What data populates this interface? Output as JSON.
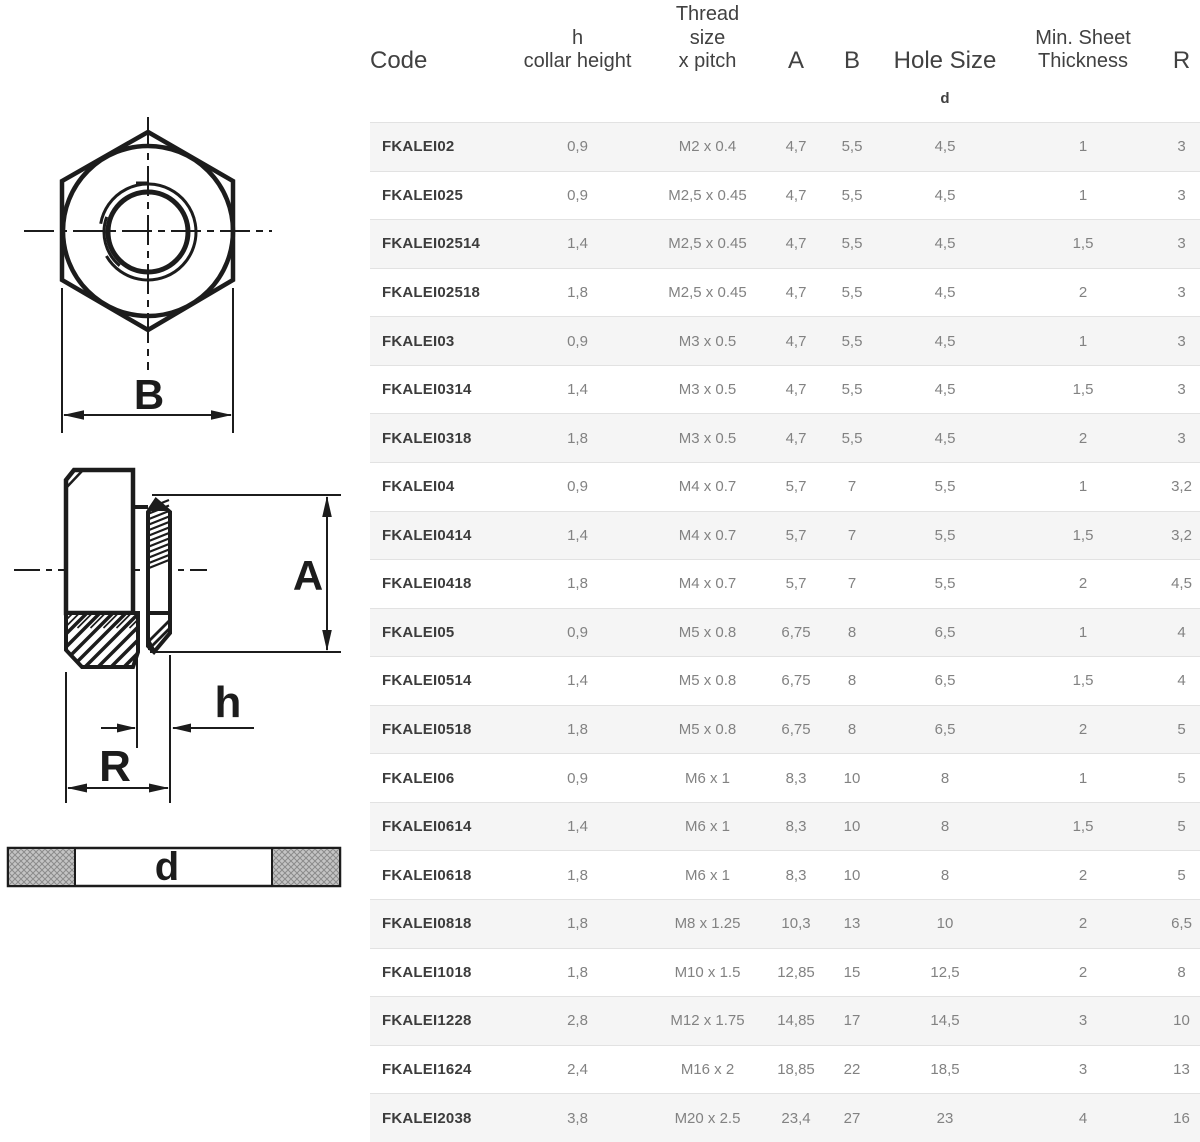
{
  "table": {
    "header": {
      "code": "Code",
      "collar": [
        "h",
        "collar height"
      ],
      "thread": [
        "Thread",
        "size",
        "x pitch"
      ],
      "a": "A",
      "b": "B",
      "hole": "Hole Size",
      "hole_sub": "d",
      "sheet": [
        "Min. Sheet",
        "Thickness"
      ],
      "r": "R"
    },
    "rows": [
      [
        "FKALEI02",
        "0,9",
        "M2 x 0.4",
        "4,7",
        "5,5",
        "4,5",
        "1",
        "3"
      ],
      [
        "FKALEI025",
        "0,9",
        "M2,5 x 0.45",
        "4,7",
        "5,5",
        "4,5",
        "1",
        "3"
      ],
      [
        "FKALEI02514",
        "1,4",
        "M2,5 x 0.45",
        "4,7",
        "5,5",
        "4,5",
        "1,5",
        "3"
      ],
      [
        "FKALEI02518",
        "1,8",
        "M2,5 x 0.45",
        "4,7",
        "5,5",
        "4,5",
        "2",
        "3"
      ],
      [
        "FKALEI03",
        "0,9",
        "M3 x 0.5",
        "4,7",
        "5,5",
        "4,5",
        "1",
        "3"
      ],
      [
        "FKALEI0314",
        "1,4",
        "M3 x 0.5",
        "4,7",
        "5,5",
        "4,5",
        "1,5",
        "3"
      ],
      [
        "FKALEI0318",
        "1,8",
        "M3 x 0.5",
        "4,7",
        "5,5",
        "4,5",
        "2",
        "3"
      ],
      [
        "FKALEI04",
        "0,9",
        "M4 x 0.7",
        "5,7",
        "7",
        "5,5",
        "1",
        "3,2"
      ],
      [
        "FKALEI0414",
        "1,4",
        "M4 x 0.7",
        "5,7",
        "7",
        "5,5",
        "1,5",
        "3,2"
      ],
      [
        "FKALEI0418",
        "1,8",
        "M4 x 0.7",
        "5,7",
        "7",
        "5,5",
        "2",
        "4,5"
      ],
      [
        "FKALEI05",
        "0,9",
        "M5 x 0.8",
        "6,75",
        "8",
        "6,5",
        "1",
        "4"
      ],
      [
        "FKALEI0514",
        "1,4",
        "M5 x 0.8",
        "6,75",
        "8",
        "6,5",
        "1,5",
        "4"
      ],
      [
        "FKALEI0518",
        "1,8",
        "M5 x 0.8",
        "6,75",
        "8",
        "6,5",
        "2",
        "5"
      ],
      [
        "FKALEI06",
        "0,9",
        "M6 x 1",
        "8,3",
        "10",
        "8",
        "1",
        "5"
      ],
      [
        "FKALEI0614",
        "1,4",
        "M6 x 1",
        "8,3",
        "10",
        "8",
        "1,5",
        "5"
      ],
      [
        "FKALEI0618",
        "1,8",
        "M6 x 1",
        "8,3",
        "10",
        "8",
        "2",
        "5"
      ],
      [
        "FKALEI0818",
        "1,8",
        "M8 x 1.25",
        "10,3",
        "13",
        "10",
        "2",
        "6,5"
      ],
      [
        "FKALEI1018",
        "1,8",
        "M10 x 1.5",
        "12,85",
        "15",
        "12,5",
        "2",
        "8"
      ],
      [
        "FKALEI1228",
        "2,8",
        "M12 x 1.75",
        "14,85",
        "17",
        "14,5",
        "3",
        "10"
      ],
      [
        "FKALEI1624",
        "2,4",
        "M16 x 2",
        "18,85",
        "22",
        "18,5",
        "3",
        "13"
      ],
      [
        "FKALEI2038",
        "3,8",
        "M20 x 2.5",
        "23,4",
        "27",
        "23",
        "4",
        "16"
      ]
    ]
  },
  "drawings": {
    "labels": {
      "b": "B",
      "a": "A",
      "h": "h",
      "r": "R",
      "d": "d"
    }
  },
  "colors": {
    "row_stripe": "#f5f5f5",
    "row_border": "#e2e2e2",
    "data_text": "#828282",
    "code_text": "#3c3c3c",
    "header_text": "#414141",
    "drawing_line": "#1c1c1c",
    "sheet_hatch": "#c4c4c4"
  }
}
